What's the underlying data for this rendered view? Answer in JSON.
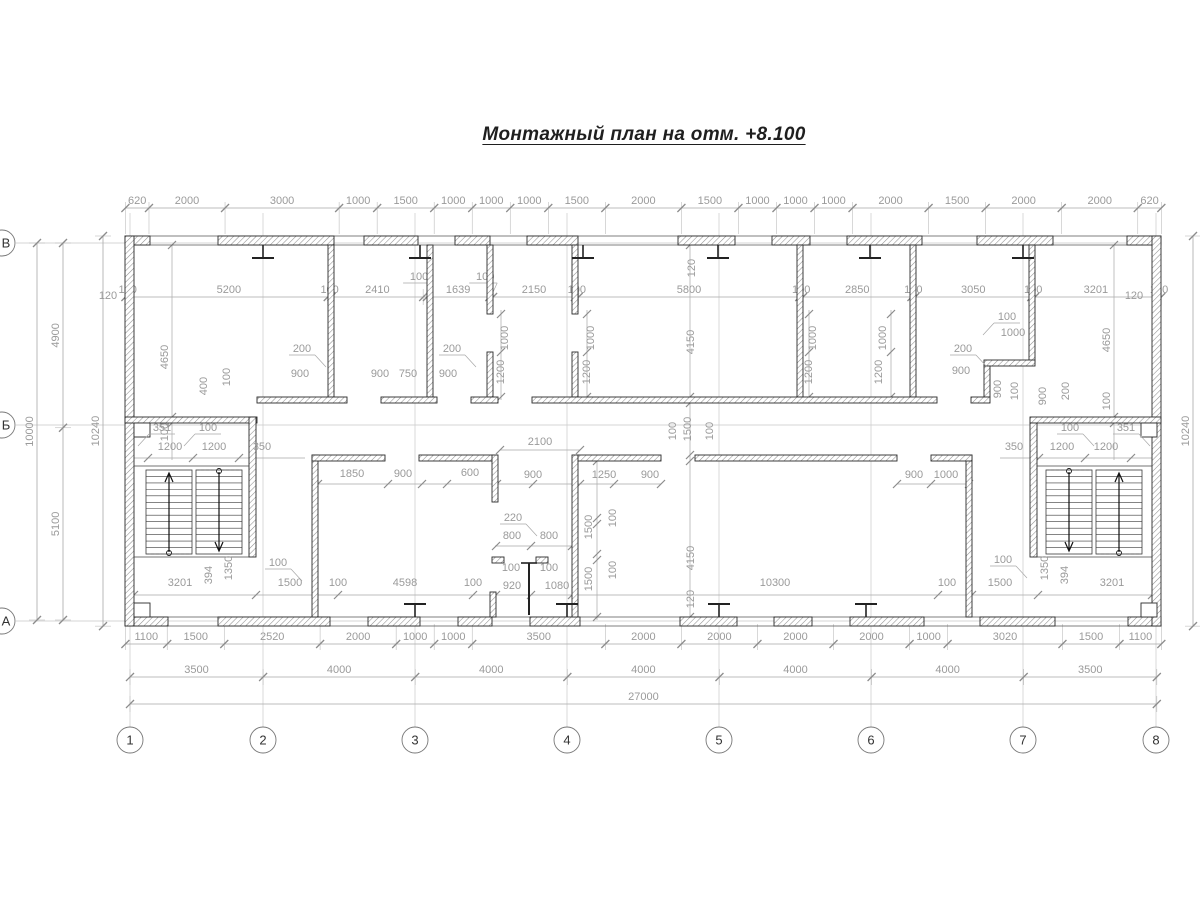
{
  "title": "Монтажный план на отм. +8.100",
  "colors": {
    "wall_outline": "#2a2a2a",
    "hatch": "#8f8f8f",
    "dim_text": "#9a9a9a",
    "dim_line": "#a8a8a8",
    "tick": "#8c8c8c",
    "grid_line": "#c9c9c9",
    "bubble_stroke": "#777777",
    "bubble_text": "#333333",
    "stair": "#3a3a3a",
    "title_text": "#1f1f1f"
  },
  "grid": {
    "cols": [
      {
        "label": "1",
        "x": 130
      },
      {
        "label": "2",
        "x": 263
      },
      {
        "label": "3",
        "x": 415
      },
      {
        "label": "4",
        "x": 567
      },
      {
        "label": "5",
        "x": 719
      },
      {
        "label": "6",
        "x": 871
      },
      {
        "label": "7",
        "x": 1023
      },
      {
        "label": "8",
        "x": 1156
      }
    ],
    "rows": [
      {
        "label": "В",
        "y": 243
      },
      {
        "label": "Б",
        "y": 425
      },
      {
        "label": "А",
        "y": 621
      }
    ],
    "bubble_y": 740,
    "bubble_x": 2,
    "bubble_r": 13
  },
  "chains": [
    {
      "name": "top-outer",
      "y": 208,
      "x0": 125.4,
      "scale": 0.03803,
      "ext": [
        6,
        26
      ],
      "values": [
        620,
        2000,
        3000,
        1000,
        1500,
        1000,
        1000,
        1000,
        1500,
        2000,
        1500,
        1000,
        1000,
        1000,
        2000,
        1500,
        2000,
        2000,
        620
      ]
    },
    {
      "name": "top-inner",
      "y": 297,
      "x0": 125.4,
      "scale": 0.03803,
      "ext": [
        8,
        8
      ],
      "leader_idx": [
        4,
        6
      ],
      "values": [
        120,
        5200,
        100,
        2410,
        100,
        1639,
        100,
        2150,
        100,
        5800,
        100,
        2850,
        100,
        3050,
        100,
        3201,
        120
      ]
    },
    {
      "name": "bottom-1",
      "y": 644,
      "x0": 125.4,
      "scale": 0.03803,
      "ext": [
        20,
        6
      ],
      "values": [
        1100,
        1500,
        2520,
        2000,
        1000,
        1000,
        3500,
        2000,
        2000,
        2000,
        2000,
        1000,
        3020,
        1500,
        1100
      ]
    },
    {
      "name": "bottom-2",
      "y": 677,
      "x0": 130,
      "scale": 0.03803,
      "ext": [
        8,
        8
      ],
      "values": [
        3500,
        4000,
        4000,
        4000,
        4000,
        4000,
        3500
      ]
    },
    {
      "name": "bottom-3",
      "y": 704,
      "x0": 130,
      "scale": 0.03803,
      "ext": [
        8,
        8
      ],
      "values": [
        27000
      ]
    }
  ],
  "vchains": [
    {
      "name": "left-total",
      "x": 37,
      "y0": 243,
      "scale": 0.0377,
      "values": [
        10000
      ]
    },
    {
      "name": "left-spans",
      "x": 63,
      "y0": 243,
      "scale": 0.0377,
      "values": [
        4900,
        5100
      ]
    },
    {
      "name": "left-overall",
      "x": 103,
      "y0": 236,
      "scale": 0.0381,
      "values": [
        10240
      ]
    },
    {
      "name": "right-overall",
      "x": 1193,
      "y0": 236,
      "scale": 0.0381,
      "values": [
        10240
      ]
    }
  ],
  "labels": [
    {
      "t": "120",
      "x": 695,
      "y": 268,
      "r": 1
    },
    {
      "t": "4650",
      "x": 168,
      "y": 357,
      "r": 1
    },
    {
      "t": "100",
      "x": 168,
      "y": 432,
      "r": 1
    },
    {
      "t": "400",
      "x": 207,
      "y": 386,
      "r": 1
    },
    {
      "t": "100",
      "x": 230,
      "y": 377,
      "r": 1
    },
    {
      "t": "200",
      "x": 302,
      "y": 352,
      "ld": 1
    },
    {
      "t": "900",
      "x": 300,
      "y": 377
    },
    {
      "t": "900",
      "x": 380,
      "y": 377
    },
    {
      "t": "750",
      "x": 408,
      "y": 377
    },
    {
      "t": "200",
      "x": 452,
      "y": 352,
      "ld": 1
    },
    {
      "t": "900",
      "x": 448,
      "y": 377
    },
    {
      "t": "1000",
      "x": 508,
      "y": 338,
      "r": 1
    },
    {
      "t": "1200",
      "x": 504,
      "y": 372,
      "r": 1
    },
    {
      "t": "1000",
      "x": 594,
      "y": 338,
      "r": 1
    },
    {
      "t": "1200",
      "x": 590,
      "y": 372,
      "r": 1
    },
    {
      "t": "4150",
      "x": 694,
      "y": 342,
      "r": 1
    },
    {
      "t": "1000",
      "x": 816,
      "y": 338,
      "r": 1
    },
    {
      "t": "1200",
      "x": 812,
      "y": 372,
      "r": 1
    },
    {
      "t": "1000",
      "x": 886,
      "y": 338,
      "r": 1
    },
    {
      "t": "1200",
      "x": 882,
      "y": 372,
      "r": 1
    },
    {
      "t": "100",
      "x": 1007,
      "y": 320,
      "ld": -1
    },
    {
      "t": "1000",
      "x": 1013,
      "y": 336
    },
    {
      "t": "200",
      "x": 963,
      "y": 352,
      "ld": 1
    },
    {
      "t": "900",
      "x": 961,
      "y": 374
    },
    {
      "t": "900",
      "x": 1001,
      "y": 389,
      "r": 1
    },
    {
      "t": "100",
      "x": 1018,
      "y": 391,
      "r": 1
    },
    {
      "t": "900",
      "x": 1046,
      "y": 396,
      "r": 1
    },
    {
      "t": "200",
      "x": 1069,
      "y": 391,
      "r": 1
    },
    {
      "t": "4650",
      "x": 1110,
      "y": 340,
      "r": 1
    },
    {
      "t": "100",
      "x": 1110,
      "y": 401,
      "r": 1
    },
    {
      "t": "120",
      "x": 108,
      "y": 299
    },
    {
      "t": "120",
      "x": 1134,
      "y": 299
    },
    {
      "t": "351",
      "x": 162,
      "y": 431,
      "ld": -1
    },
    {
      "t": "100",
      "x": 208,
      "y": 431,
      "ld": -1
    },
    {
      "t": "1200",
      "x": 170,
      "y": 450
    },
    {
      "t": "1200",
      "x": 214,
      "y": 450
    },
    {
      "t": "350",
      "x": 262,
      "y": 450
    },
    {
      "t": "350",
      "x": 1014,
      "y": 450
    },
    {
      "t": "100",
      "x": 1070,
      "y": 431,
      "ld": 1
    },
    {
      "t": "1200",
      "x": 1062,
      "y": 450
    },
    {
      "t": "1200",
      "x": 1106,
      "y": 450
    },
    {
      "t": "351",
      "x": 1126,
      "y": 431,
      "ld": 1
    },
    {
      "t": "2100",
      "x": 540,
      "y": 445
    },
    {
      "t": "100",
      "x": 676,
      "y": 431,
      "r": 1
    },
    {
      "t": "1500",
      "x": 691,
      "y": 429,
      "r": 1
    },
    {
      "t": "100",
      "x": 713,
      "y": 431,
      "r": 1
    },
    {
      "t": "1850",
      "x": 352,
      "y": 477
    },
    {
      "t": "900",
      "x": 403,
      "y": 477
    },
    {
      "t": "600",
      "x": 470,
      "y": 476
    },
    {
      "t": "900",
      "x": 533,
      "y": 478
    },
    {
      "t": "1250",
      "x": 604,
      "y": 478
    },
    {
      "t": "900",
      "x": 650,
      "y": 478
    },
    {
      "t": "900",
      "x": 914,
      "y": 478
    },
    {
      "t": "1000",
      "x": 946,
      "y": 478
    },
    {
      "t": "220",
      "x": 513,
      "y": 521,
      "ld": 1
    },
    {
      "t": "800",
      "x": 512,
      "y": 539
    },
    {
      "t": "800",
      "x": 549,
      "y": 539
    },
    {
      "t": "100",
      "x": 511,
      "y": 571
    },
    {
      "t": "100",
      "x": 549,
      "y": 571
    },
    {
      "t": "920",
      "x": 512,
      "y": 589
    },
    {
      "t": "1080",
      "x": 557,
      "y": 589
    },
    {
      "t": "1500",
      "x": 592,
      "y": 527,
      "r": 1
    },
    {
      "t": "100",
      "x": 616,
      "y": 518,
      "r": 1
    },
    {
      "t": "1500",
      "x": 592,
      "y": 579,
      "r": 1
    },
    {
      "t": "100",
      "x": 616,
      "y": 570,
      "r": 1
    },
    {
      "t": "4150",
      "x": 694,
      "y": 558,
      "r": 1
    },
    {
      "t": "120",
      "x": 694,
      "y": 599,
      "r": 1
    },
    {
      "t": "3201",
      "x": 180,
      "y": 586
    },
    {
      "t": "394",
      "x": 212,
      "y": 575,
      "r": 1
    },
    {
      "t": "1350",
      "x": 232,
      "y": 568,
      "r": 1
    },
    {
      "t": "100",
      "x": 278,
      "y": 566,
      "ld": 1
    },
    {
      "t": "1500",
      "x": 290,
      "y": 586
    },
    {
      "t": "100",
      "x": 338,
      "y": 586
    },
    {
      "t": "4598",
      "x": 405,
      "y": 586
    },
    {
      "t": "100",
      "x": 473,
      "y": 586
    },
    {
      "t": "10300",
      "x": 775,
      "y": 586
    },
    {
      "t": "100",
      "x": 947,
      "y": 586
    },
    {
      "t": "1500",
      "x": 1000,
      "y": 586
    },
    {
      "t": "100",
      "x": 1003,
      "y": 563,
      "ld": 1
    },
    {
      "t": "1350",
      "x": 1048,
      "y": 568,
      "r": 1
    },
    {
      "t": "394",
      "x": 1068,
      "y": 575,
      "r": 1
    },
    {
      "t": "3201",
      "x": 1112,
      "y": 586
    }
  ]
}
